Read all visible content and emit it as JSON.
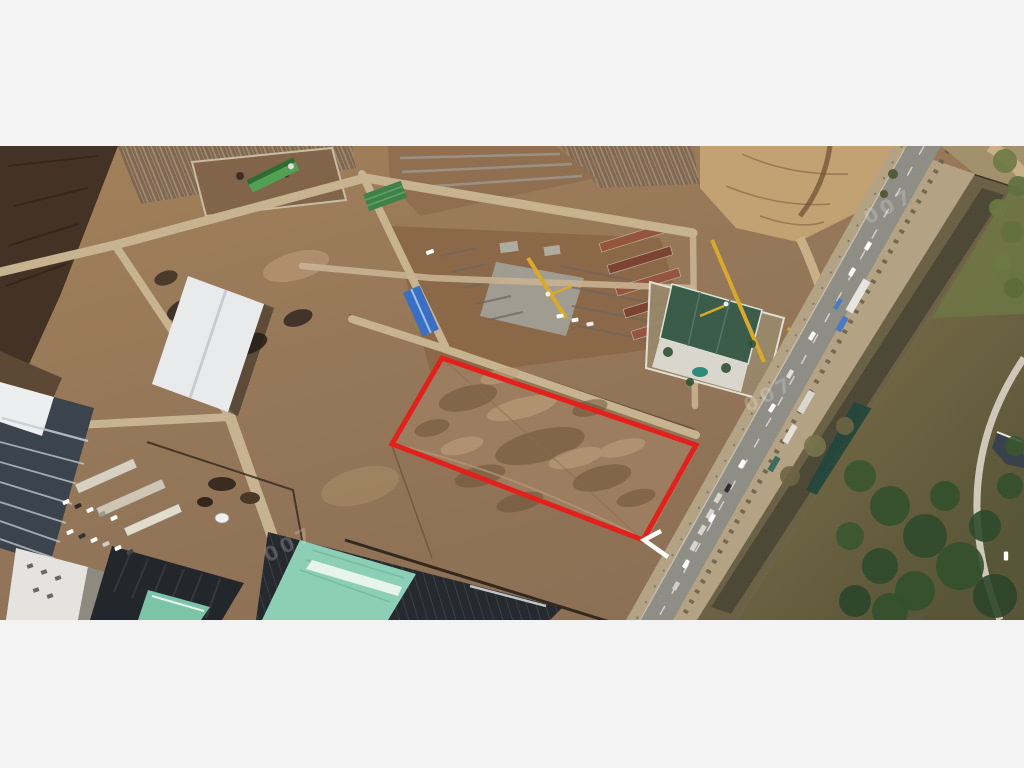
{
  "letterbox": {
    "color": "#f3f3f3"
  },
  "scene": {
    "watermark_text": "007",
    "watermarks": [
      {
        "x": 262,
        "y": 386
      },
      {
        "x": 742,
        "y": 236
      },
      {
        "x": 862,
        "y": 48
      }
    ],
    "annotation": {
      "label": "parcel-outline",
      "color": "#E2211C",
      "stroke_width": 5,
      "points": "442,212 696,299 643,394 392,298",
      "arrow_color": "#FFFFFF",
      "arrow_points": "661,385 644,394 668,411"
    },
    "palette": {
      "dirt_base": "#A28159",
      "dirt_dark": "#6A5037",
      "road_dirt": "#C8B391",
      "asphalt": "#8E8E86",
      "canal_water": "#4E4936",
      "pond": "#24473C",
      "scrub": "#7B6B4B",
      "trees": "#33502E",
      "warehouse_roof": "#E9EAEB",
      "teal_roof": "#8CCFB6",
      "teal_roof_small": "#7CC4A8",
      "dark_frame": "#23272B",
      "highrise_facade": "#3B434D",
      "sales_office_roof": "#3B5C49",
      "crane_yellow": "#D9A92E",
      "blue_roof": "#3A6FC4",
      "green_net": "#41804A",
      "brick_rows": "#94543D"
    },
    "vehicles": [
      {
        "x": 868,
        "y": 100,
        "a": -60,
        "c": "#FFFFFF"
      },
      {
        "x": 852,
        "y": 126,
        "a": -60,
        "c": "#FFFFFF"
      },
      {
        "x": 838,
        "y": 158,
        "a": -60,
        "c": "#4A79C4",
        "w": 12
      },
      {
        "x": 812,
        "y": 190,
        "a": -60,
        "c": "#FFFFFF"
      },
      {
        "x": 790,
        "y": 228,
        "a": -60,
        "c": "#DEDEDE"
      },
      {
        "x": 772,
        "y": 262,
        "a": -60,
        "c": "#FFFFFF"
      },
      {
        "x": 742,
        "y": 318,
        "a": -60,
        "c": "#FFFFFF"
      },
      {
        "x": 728,
        "y": 342,
        "a": -60,
        "c": "#2E2E2E"
      },
      {
        "x": 712,
        "y": 372,
        "a": -60,
        "c": "#FFFFFF"
      },
      {
        "x": 686,
        "y": 418,
        "a": -60,
        "c": "#FFFFFF"
      },
      {
        "x": 676,
        "y": 440,
        "a": -60,
        "c": "#CFCFCF"
      },
      {
        "x": 1006,
        "y": 410,
        "a": 90,
        "c": "#FFFFFF"
      },
      {
        "x": 66,
        "y": 356,
        "a": -24,
        "c": "#FFFFFF",
        "w": 7,
        "h": 4
      },
      {
        "x": 78,
        "y": 360,
        "a": -24,
        "c": "#2B2B2B",
        "w": 7,
        "h": 4
      },
      {
        "x": 90,
        "y": 364,
        "a": -24,
        "c": "#FFFFFF",
        "w": 7,
        "h": 4
      },
      {
        "x": 102,
        "y": 368,
        "a": -24,
        "c": "#9A9A9A",
        "w": 7,
        "h": 4
      },
      {
        "x": 114,
        "y": 372,
        "a": -24,
        "c": "#FFFFFF",
        "w": 7,
        "h": 4
      },
      {
        "x": 70,
        "y": 386,
        "a": -24,
        "c": "#FFFFFF",
        "w": 7,
        "h": 4
      },
      {
        "x": 82,
        "y": 390,
        "a": -24,
        "c": "#333333",
        "w": 7,
        "h": 4
      },
      {
        "x": 94,
        "y": 394,
        "a": -24,
        "c": "#FFFFFF",
        "w": 7,
        "h": 4
      },
      {
        "x": 106,
        "y": 398,
        "a": -24,
        "c": "#CCCCCC",
        "w": 7,
        "h": 4
      },
      {
        "x": 118,
        "y": 402,
        "a": -24,
        "c": "#FFFFFF",
        "w": 7,
        "h": 4
      },
      {
        "x": 130,
        "y": 406,
        "a": -24,
        "c": "#444444",
        "w": 7,
        "h": 4
      },
      {
        "x": 560,
        "y": 170,
        "a": -10,
        "c": "#FFFFFF",
        "w": 7,
        "h": 4
      },
      {
        "x": 575,
        "y": 174,
        "a": -10,
        "c": "#FFFFFF",
        "w": 7,
        "h": 4
      },
      {
        "x": 590,
        "y": 178,
        "a": -10,
        "c": "#EDEDED",
        "w": 7,
        "h": 4
      },
      {
        "x": 430,
        "y": 106,
        "a": -20,
        "c": "#FFFFFF",
        "w": 8,
        "h": 4
      }
    ],
    "trees": [
      {
        "x": 1005,
        "y": 15,
        "r": 12,
        "c": "#6B7A45"
      },
      {
        "x": 1018,
        "y": 40,
        "r": 10,
        "c": "#5F7040"
      },
      {
        "x": 998,
        "y": 62,
        "r": 9,
        "c": "#6B7A45"
      },
      {
        "x": 1012,
        "y": 86,
        "r": 11,
        "c": "#62713F"
      },
      {
        "x": 1002,
        "y": 116,
        "r": 9,
        "c": "#6B7A45"
      },
      {
        "x": 1014,
        "y": 142,
        "r": 10,
        "c": "#5C6B3C"
      },
      {
        "x": 860,
        "y": 330,
        "r": 16,
        "c": "#3A5531"
      },
      {
        "x": 890,
        "y": 360,
        "r": 20,
        "c": "#33502E"
      },
      {
        "x": 925,
        "y": 390,
        "r": 22,
        "c": "#2F4A2C"
      },
      {
        "x": 960,
        "y": 420,
        "r": 24,
        "c": "#33502E"
      },
      {
        "x": 995,
        "y": 450,
        "r": 22,
        "c": "#2C452A"
      },
      {
        "x": 880,
        "y": 420,
        "r": 18,
        "c": "#2F4A2C"
      },
      {
        "x": 915,
        "y": 445,
        "r": 20,
        "c": "#33502E"
      },
      {
        "x": 850,
        "y": 390,
        "r": 14,
        "c": "#3A5531"
      },
      {
        "x": 945,
        "y": 350,
        "r": 15,
        "c": "#33502E"
      },
      {
        "x": 985,
        "y": 380,
        "r": 16,
        "c": "#2F4A2C"
      },
      {
        "x": 1010,
        "y": 340,
        "r": 13,
        "c": "#33502E"
      },
      {
        "x": 855,
        "y": 455,
        "r": 16,
        "c": "#2C452A"
      },
      {
        "x": 890,
        "y": 465,
        "r": 18,
        "c": "#33502E"
      },
      {
        "x": 1015,
        "y": 300,
        "r": 10,
        "c": "#3A5531"
      },
      {
        "x": 790,
        "y": 330,
        "r": 10,
        "c": "#6E6443"
      },
      {
        "x": 815,
        "y": 300,
        "r": 11,
        "c": "#77744C"
      },
      {
        "x": 845,
        "y": 280,
        "r": 9,
        "c": "#6E6443"
      },
      {
        "x": 668,
        "y": 206,
        "r": 5,
        "c": "#2E5231"
      },
      {
        "x": 726,
        "y": 222,
        "r": 5,
        "c": "#2E5231"
      },
      {
        "x": 752,
        "y": 198,
        "r": 4,
        "c": "#2E5231"
      },
      {
        "x": 690,
        "y": 236,
        "r": 4,
        "c": "#2E5231"
      },
      {
        "x": 893,
        "y": 28,
        "r": 5,
        "c": "#4A5532"
      },
      {
        "x": 884,
        "y": 48,
        "r": 4,
        "c": "#4A5532"
      }
    ]
  }
}
